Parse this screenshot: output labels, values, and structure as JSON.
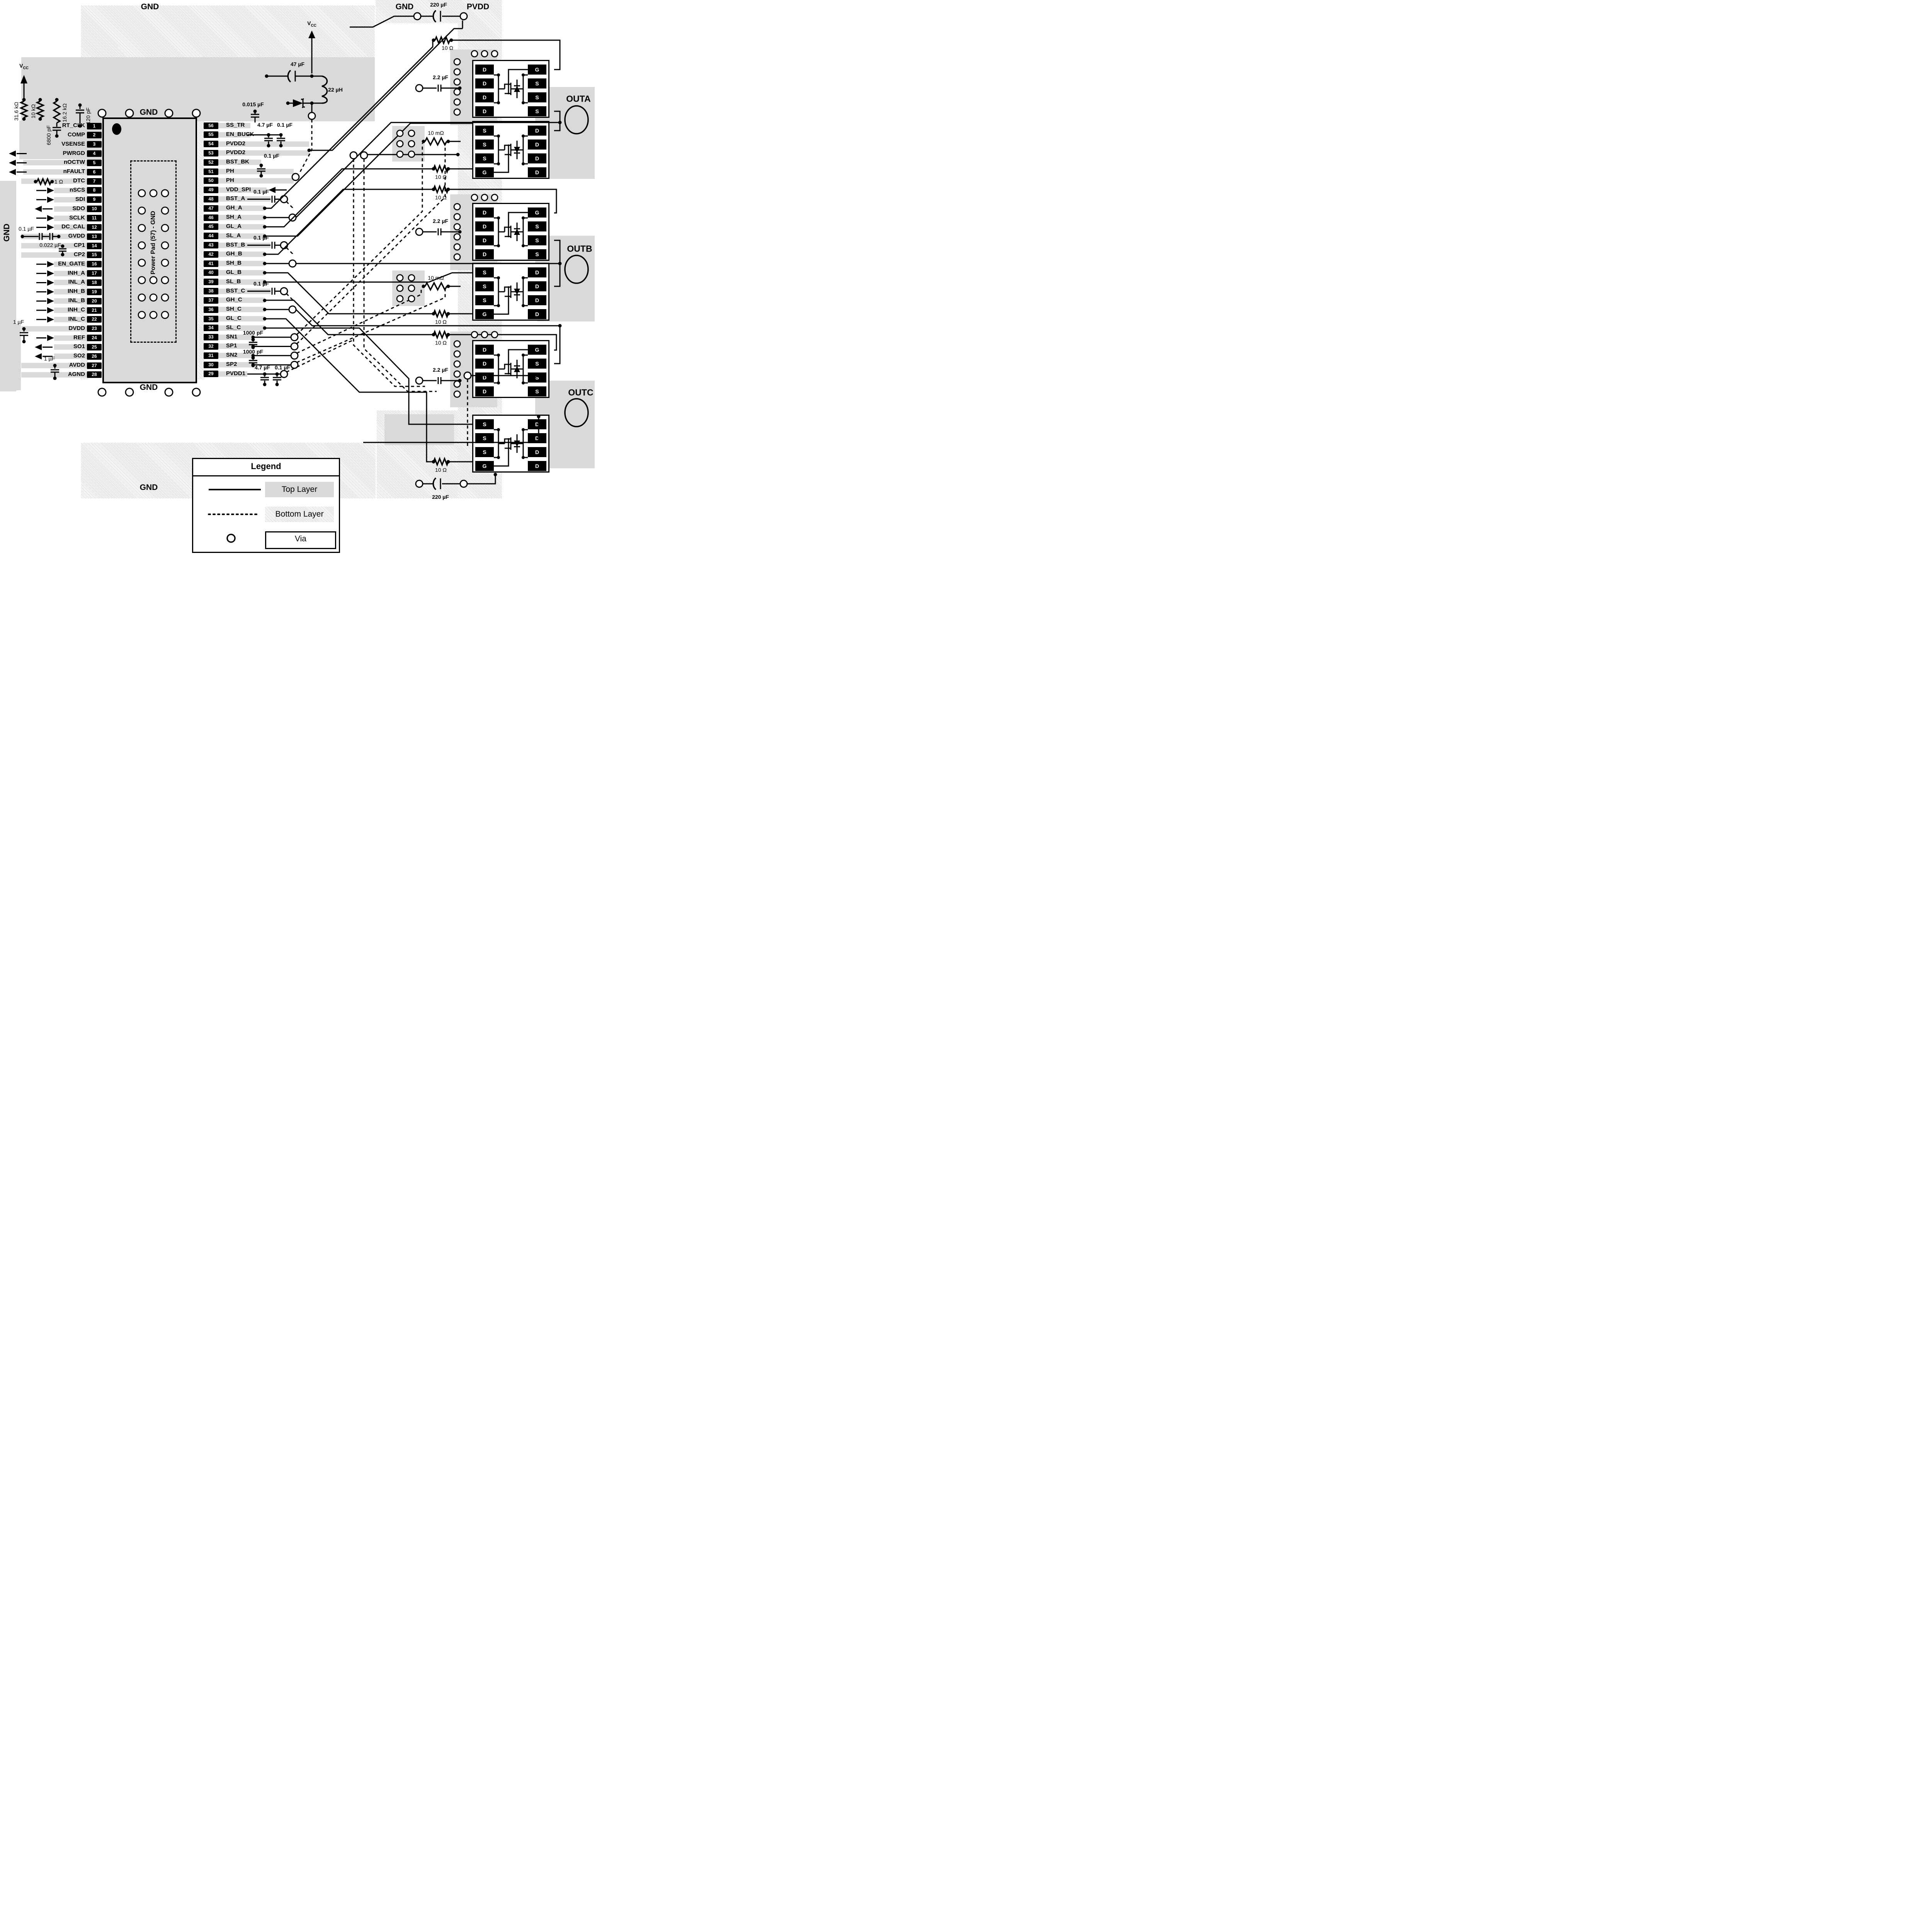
{
  "labels": {
    "gnd_top_left": "GND",
    "gnd_top_right": "GND",
    "pvdd_top": "PVDD",
    "cap_220_top": "220 µF",
    "vcc_v": "V",
    "vcc_sub": "CC",
    "r31k6": "31.6 kΩ",
    "r10k": "10 kΩ",
    "r16k2": "16.2 kΩ",
    "c6800": "6800 pF",
    "c120": "120 pF",
    "cap_47": "47 µF",
    "ind_22": "22 µH",
    "c0015": "0.015 µF",
    "c47_buck": "4.7 µF",
    "c01_buck": "0.1 µF",
    "c01_bstbk": "0.1 µF",
    "c01_bsta": "0.1 µF",
    "c01_bstb": "0.1 µF",
    "c01_bstc": "0.1 µF",
    "c1000_1": "1000 pF",
    "c1000_2": "1000 pF",
    "c47_pvdd1": "4.7 µF",
    "c01_pvdd1": "0.1 µF",
    "r1ohm": "1 Ω",
    "c01_gvdd": "0.1 µF",
    "c0022": "0.022 µF",
    "c1_dvdd": "1 µF",
    "c1_avdd": "1 µF",
    "gnd_above_ic": "GND",
    "gnd_below_ic": "GND",
    "gnd_left": "GND",
    "gnd_bottom": "GND",
    "power_pad": "Power Pad (57) - GND",
    "r10_1": "10 Ω",
    "r10_2": "10 Ω",
    "r10_3": "10 Ω",
    "r10_4": "10 Ω",
    "r10_5": "10 Ω",
    "r10_6": "10 Ω",
    "rsh_a": "10 mΩ",
    "rsh_b": "10 mΩ",
    "c22_a": "2.2 µF",
    "c22_b": "2.2 µF",
    "c22_c": "2.2 µF",
    "cap_220_bottom": "220 µF",
    "outa": "OUTA",
    "outb": "OUTB",
    "outc": "OUTC"
  },
  "legend": {
    "title": "Legend",
    "top": "Top Layer",
    "bottom": "Bottom Layer",
    "via": "Via"
  },
  "ic": {
    "left_pins": [
      {
        "num": "1",
        "name": "RT_CLK",
        "dir": ""
      },
      {
        "num": "2",
        "name": "COMP",
        "dir": ""
      },
      {
        "num": "3",
        "name": "VSENSE",
        "dir": ""
      },
      {
        "num": "4",
        "name": "PWRGD",
        "dir": "out-long"
      },
      {
        "num": "5",
        "name": "nOCTW",
        "dir": "out-long"
      },
      {
        "num": "6",
        "name": "nFAULT",
        "dir": "out-long"
      },
      {
        "num": "7",
        "name": "DTC",
        "dir": ""
      },
      {
        "num": "8",
        "name": "nSCS",
        "dir": "in"
      },
      {
        "num": "9",
        "name": "SDI",
        "dir": "in"
      },
      {
        "num": "10",
        "name": "SDO",
        "dir": "out"
      },
      {
        "num": "11",
        "name": "SCLK",
        "dir": "in"
      },
      {
        "num": "12",
        "name": "DC_CAL",
        "dir": "in"
      },
      {
        "num": "13",
        "name": "GVDD",
        "dir": ""
      },
      {
        "num": "14",
        "name": "CP1",
        "dir": ""
      },
      {
        "num": "15",
        "name": "CP2",
        "dir": ""
      },
      {
        "num": "16",
        "name": "EN_GATE",
        "dir": "in"
      },
      {
        "num": "17",
        "name": "INH_A",
        "dir": "in"
      },
      {
        "num": "18",
        "name": "INL_A",
        "dir": "in"
      },
      {
        "num": "19",
        "name": "INH_B",
        "dir": "in"
      },
      {
        "num": "20",
        "name": "INL_B",
        "dir": "in"
      },
      {
        "num": "21",
        "name": "INH_C",
        "dir": "in"
      },
      {
        "num": "22",
        "name": "INL_C",
        "dir": "in"
      },
      {
        "num": "23",
        "name": "DVDD",
        "dir": ""
      },
      {
        "num": "24",
        "name": "REF",
        "dir": "in"
      },
      {
        "num": "25",
        "name": "SO1",
        "dir": "out"
      },
      {
        "num": "26",
        "name": "SO2",
        "dir": "out"
      },
      {
        "num": "27",
        "name": "AVDD",
        "dir": ""
      },
      {
        "num": "28",
        "name": "AGND",
        "dir": ""
      }
    ],
    "right_pins": [
      {
        "num": "56",
        "name": "SS_TR"
      },
      {
        "num": "55",
        "name": "EN_BUCK"
      },
      {
        "num": "54",
        "name": "PVDD2"
      },
      {
        "num": "53",
        "name": "PVDD2"
      },
      {
        "num": "52",
        "name": "BST_BK"
      },
      {
        "num": "51",
        "name": "PH"
      },
      {
        "num": "50",
        "name": "PH"
      },
      {
        "num": "49",
        "name": "VDD_SPI"
      },
      {
        "num": "48",
        "name": "BST_A"
      },
      {
        "num": "47",
        "name": "GH_A"
      },
      {
        "num": "46",
        "name": "SH_A"
      },
      {
        "num": "45",
        "name": "GL_A"
      },
      {
        "num": "44",
        "name": "SL_A"
      },
      {
        "num": "43",
        "name": "BST_B"
      },
      {
        "num": "42",
        "name": "GH_B"
      },
      {
        "num": "41",
        "name": "SH_B"
      },
      {
        "num": "40",
        "name": "GL_B"
      },
      {
        "num": "39",
        "name": "SL_B"
      },
      {
        "num": "38",
        "name": "BST_C"
      },
      {
        "num": "37",
        "name": "GH_C"
      },
      {
        "num": "36",
        "name": "SH_C"
      },
      {
        "num": "35",
        "name": "GL_C"
      },
      {
        "num": "34",
        "name": "SL_C"
      },
      {
        "num": "33",
        "name": "SN1"
      },
      {
        "num": "32",
        "name": "SP1"
      },
      {
        "num": "31",
        "name": "SN2"
      },
      {
        "num": "30",
        "name": "SP2"
      },
      {
        "num": "29",
        "name": "PVDD1"
      }
    ]
  },
  "mosfets": [
    {
      "id": "outa-high",
      "left": [
        "D",
        "D",
        "D",
        "D"
      ],
      "right": [
        "G",
        "S",
        "S",
        "S"
      ]
    },
    {
      "id": "outa-low",
      "left": [
        "S",
        "S",
        "S",
        "G"
      ],
      "right": [
        "D",
        "D",
        "D",
        "D"
      ]
    },
    {
      "id": "outb-high",
      "left": [
        "D",
        "D",
        "D",
        "D"
      ],
      "right": [
        "G",
        "S",
        "S",
        "S"
      ]
    },
    {
      "id": "outb-low",
      "left": [
        "S",
        "S",
        "S",
        "G"
      ],
      "right": [
        "D",
        "D",
        "D",
        "D"
      ]
    },
    {
      "id": "outc-high",
      "left": [
        "D",
        "D",
        "D",
        "D"
      ],
      "right": [
        "G",
        "S",
        "S",
        "S"
      ]
    },
    {
      "id": "outc-low",
      "left": [
        "S",
        "S",
        "S",
        "G"
      ],
      "right": [
        "D",
        "D",
        "D",
        "D"
      ]
    }
  ]
}
